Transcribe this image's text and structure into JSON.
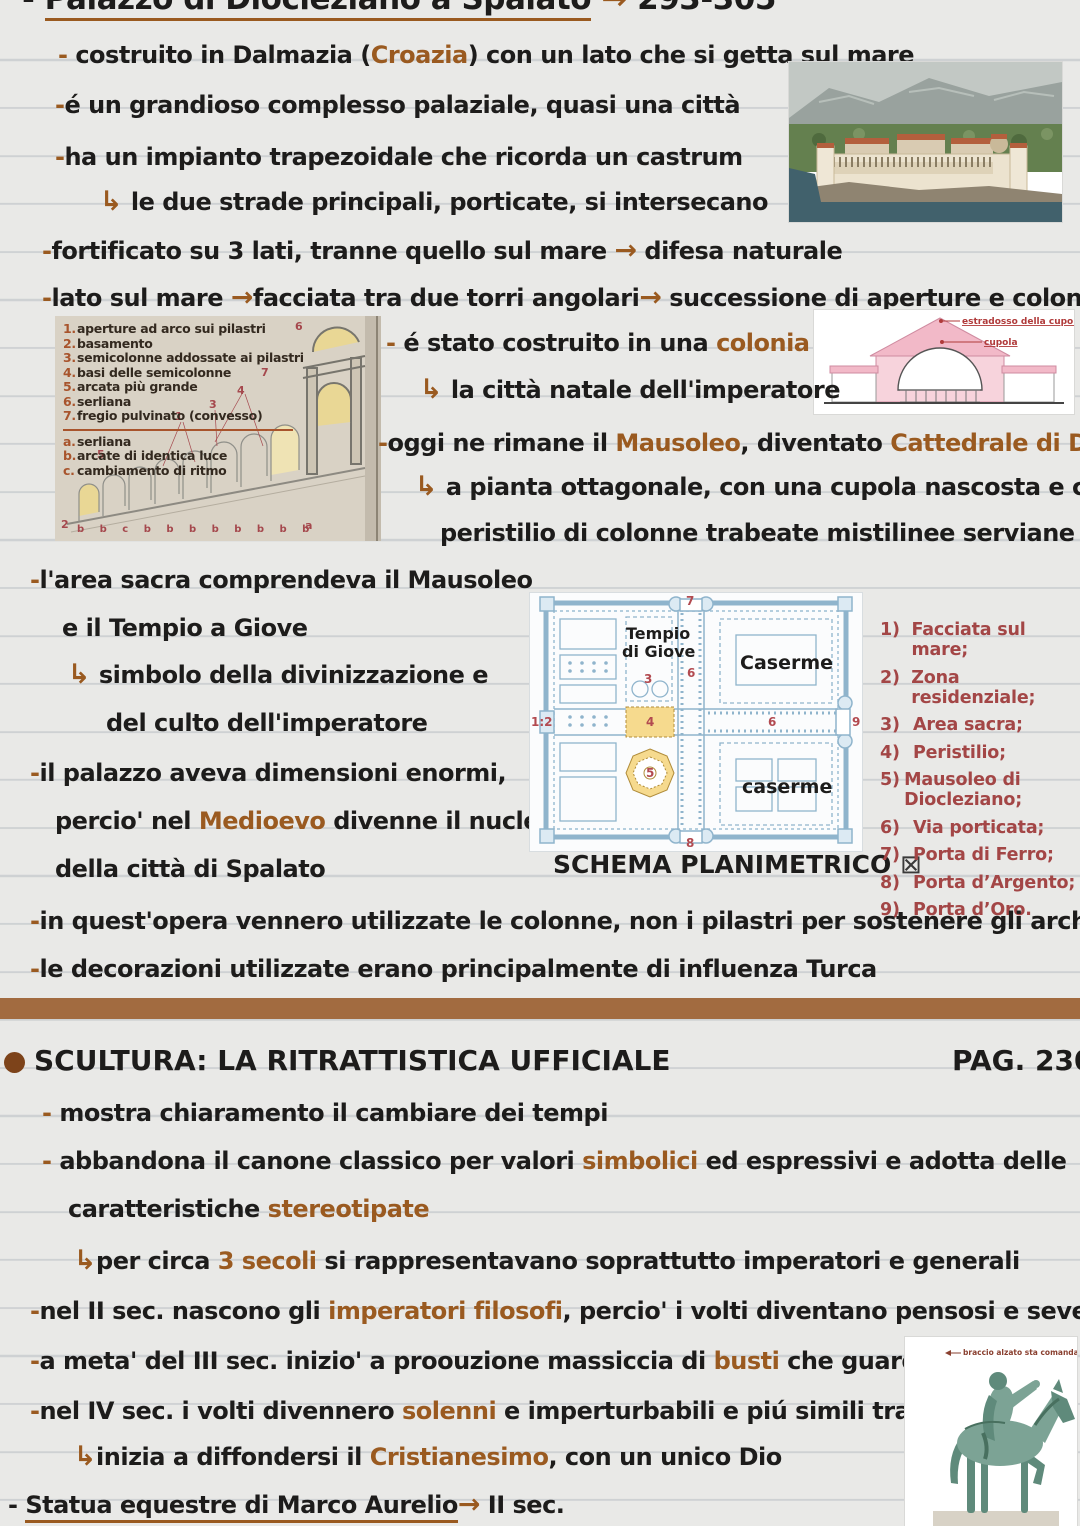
{
  "title": {
    "segments": [
      {
        "t": "- "
      },
      {
        "t": "Palazzo di Diocleziano a Spalato",
        "c": "ul"
      },
      {
        "t": " "
      },
      {
        "t": "→",
        "c": "a"
      },
      {
        "t": " 293-305"
      }
    ]
  },
  "lines": {
    "costruito": [
      {
        "t": "- ",
        "c": "a"
      },
      {
        "t": "costruito in Dalmazia ("
      },
      {
        "t": "Croazia",
        "c": "a"
      },
      {
        "t": ") con un lato che si getta sul mare"
      }
    ],
    "grandioso": [
      {
        "t": "-",
        "c": "a"
      },
      {
        "t": "é un grandioso complesso palaziale, quasi una città"
      }
    ],
    "impianto": [
      {
        "t": "-",
        "c": "a"
      },
      {
        "t": "ha un impianto trapezoidale che ricorda un castrum"
      }
    ],
    "strade": [
      {
        "t": "↳ ",
        "c": "arr"
      },
      {
        "t": "le due strade principali, porticate, si intersecano"
      }
    ],
    "fortificato": [
      {
        "t": "-",
        "c": "a"
      },
      {
        "t": "fortificato su 3 lati, tranne quello sul mare "
      },
      {
        "t": "→",
        "c": "arr"
      },
      {
        "t": " difesa naturale"
      }
    ],
    "lato_mare": [
      {
        "t": "-",
        "c": "a"
      },
      {
        "t": "lato sul mare "
      },
      {
        "t": "→",
        "c": "arr"
      },
      {
        "t": "facciata tra due torri angolari"
      },
      {
        "t": "→",
        "c": "arr"
      },
      {
        "t": " successione di aperture e colonne"
      }
    ],
    "colonia": [
      {
        "t": "- ",
        "c": "a"
      },
      {
        "t": "é stato costruito in una "
      },
      {
        "t": "colonia",
        "c": "a"
      }
    ],
    "citta_natale": [
      {
        "t": "↳ ",
        "c": "arr"
      },
      {
        "t": "la città natale dell'imperatore"
      }
    ],
    "mausoleo": [
      {
        "t": "-",
        "c": "a"
      },
      {
        "t": "oggi ne rimane il "
      },
      {
        "t": "Mausoleo",
        "c": "a"
      },
      {
        "t": ", diventato "
      },
      {
        "t": "Cattedrale di Doimo",
        "c": "a"
      }
    ],
    "pianta": [
      {
        "t": "↳ ",
        "c": "arr"
      },
      {
        "t": "a pianta ottagonale, con una cupola nascosta e con un"
      }
    ],
    "peristilio": [
      {
        "t": "peristilio di colonne trabeate mistilinee serviane"
      }
    ],
    "area_sacra_1": [
      {
        "t": "-",
        "c": "a"
      },
      {
        "t": "l'area sacra comprendeva il Mausoleo"
      }
    ],
    "area_sacra_2": [
      {
        "t": "e il Tempio a Giove"
      }
    ],
    "simbolo_1": [
      {
        "t": "↳ ",
        "c": "arr"
      },
      {
        "t": "simbolo della divinizzazione e"
      }
    ],
    "simbolo_2": [
      {
        "t": "del culto dell'imperatore"
      }
    ],
    "palazzo_1": [
      {
        "t": "-",
        "c": "a"
      },
      {
        "t": "il palazzo aveva dimensioni enormi,"
      }
    ],
    "palazzo_2": [
      {
        "t": "percio' nel "
      },
      {
        "t": "Medioevo",
        "c": "a"
      },
      {
        "t": " divenne il nucleo"
      }
    ],
    "palazzo_3": [
      {
        "t": "della città di Spalato"
      }
    ],
    "colonne": [
      {
        "t": "-",
        "c": "a"
      },
      {
        "t": "in quest'opera vennero utilizzate le colonne, non i pilastri per sostenere gli archi"
      }
    ],
    "decorazioni": [
      {
        "t": "-",
        "c": "a"
      },
      {
        "t": "le decorazioni utilizzate erano principalmente di influenza Turca"
      }
    ],
    "mostra": [
      {
        "t": "- ",
        "c": "a"
      },
      {
        "t": "mostra chiaramento il cambiare dei tempi"
      }
    ],
    "abbandona": [
      {
        "t": "- ",
        "c": "a"
      },
      {
        "t": "abbandona il canone classico per valori "
      },
      {
        "t": "simbolici",
        "c": "a"
      },
      {
        "t": " ed espressivi e adotta delle"
      }
    ],
    "caratteristiche": [
      {
        "t": "caratteristiche "
      },
      {
        "t": "stereotipate",
        "c": "a"
      }
    ],
    "tre_secoli": [
      {
        "t": "↳",
        "c": "arr"
      },
      {
        "t": "per circa "
      },
      {
        "t": "3 secoli",
        "c": "a"
      },
      {
        "t": " si rappresentavano soprattutto imperatori e generali"
      }
    ],
    "secondo_sec": [
      {
        "t": "-",
        "c": "a"
      },
      {
        "t": "nel II sec. nascono gli "
      },
      {
        "t": "imperatori filosofi",
        "c": "a"
      },
      {
        "t": ", percio' i volti diventano pensosi e severi"
      }
    ],
    "terzo_sec": [
      {
        "t": "-",
        "c": "a"
      },
      {
        "t": "a meta' del III sec. inizio' a proouzione massiccia di "
      },
      {
        "t": "busti",
        "c": "a"
      },
      {
        "t": " che guardano in alto"
      }
    ],
    "quarto_sec": [
      {
        "t": "-",
        "c": "a"
      },
      {
        "t": "nel IV sec. i volti divennero "
      },
      {
        "t": "solenni",
        "c": "a"
      },
      {
        "t": " e imperturbabili e piú simili tra loro"
      }
    ],
    "cristianesimo": [
      {
        "t": "↳",
        "c": "arr"
      },
      {
        "t": "inizia a diffondersi il "
      },
      {
        "t": "Cristianesimo",
        "c": "a"
      },
      {
        "t": ", con un unico Dio"
      }
    ],
    "statua": [
      {
        "t": "- "
      },
      {
        "t": "Statua equestre di Marco Aurelio",
        "c": "ul"
      },
      {
        "t": "→",
        "c": "arr"
      },
      {
        "t": " II sec."
      }
    ]
  },
  "sculpture_header": {
    "title": "SCULTURA: LA RITRATTISTICA UFFICIALE",
    "page_ref": "PAG. 230"
  },
  "arcade_figure": {
    "numbered": [
      {
        "n": "1.",
        "t": "aperture ad arco sui pilastri"
      },
      {
        "n": "2.",
        "t": "basamento"
      },
      {
        "n": "3.",
        "t": "semicolonne addossate ai pilastri"
      },
      {
        "n": "4.",
        "t": "basi delle semicolonne"
      },
      {
        "n": "5.",
        "t": "arcata più grande"
      },
      {
        "n": "6.",
        "t": "serliana"
      },
      {
        "n": "7.",
        "t": "fregio pulvinato (convesso)"
      }
    ],
    "lettered": [
      {
        "n": "a.",
        "t": "serliana"
      },
      {
        "n": "b.",
        "t": "arcate di identica luce"
      },
      {
        "n": "c.",
        "t": "cambiamento di ritmo"
      }
    ],
    "markers": {
      "m1": "1",
      "m2": "2",
      "m3": "3",
      "m4": "4",
      "m5": "5",
      "m6": "6",
      "m7": "7",
      "ma": "a"
    },
    "bottom_letters": "b  b  c  b  b  b  b  b  b    b    b"
  },
  "cupola_figure": {
    "label_estradosso": "estradosso della cupola",
    "label_cupola": "cupola"
  },
  "plan_figure": {
    "temple_line1": "Tempio",
    "temple_line2": "di Giove",
    "caserme_top": "Caserme",
    "caserme_bottom": "caserme",
    "caption": "SCHEMA PLANIMETRICO",
    "caption_symbol": "⊠",
    "numbers": {
      "n12": "1:2",
      "n3": "3",
      "n4": "4",
      "n5": "5",
      "n6a": "6",
      "n6b": "6",
      "n7": "7",
      "n8": "8",
      "n9": "9"
    }
  },
  "legend": {
    "items": [
      {
        "n": "1)",
        "t": "Facciata sul mare;"
      },
      {
        "n": "2)",
        "t": "Zona residenziale;"
      },
      {
        "n": "3)",
        "t": "Area sacra;"
      },
      {
        "n": "4)",
        "t": "Peristilio;"
      },
      {
        "n": "5)",
        "t": "Mausoleo di Diocleziano;"
      },
      {
        "n": "6)",
        "t": "Via porticata;"
      },
      {
        "n": "7)",
        "t": "Porta di Ferro;"
      },
      {
        "n": "8)",
        "t": "Porta d’Argento;"
      },
      {
        "n": "9)",
        "t": "Porta d’Oro."
      }
    ]
  },
  "statue_figure": {
    "label": "braccio alzato sta comandando"
  },
  "colors": {
    "accent_brown": "#9a5a20",
    "divider_brown": "#a26b40",
    "legend_red": "#a34646",
    "plan_red": "#b24a50",
    "highlight_yellow": "#f6da8e",
    "plan_blue": "#8fb4cc",
    "pink": "#f2b9c8",
    "ink_black": "#1d1c1b"
  }
}
